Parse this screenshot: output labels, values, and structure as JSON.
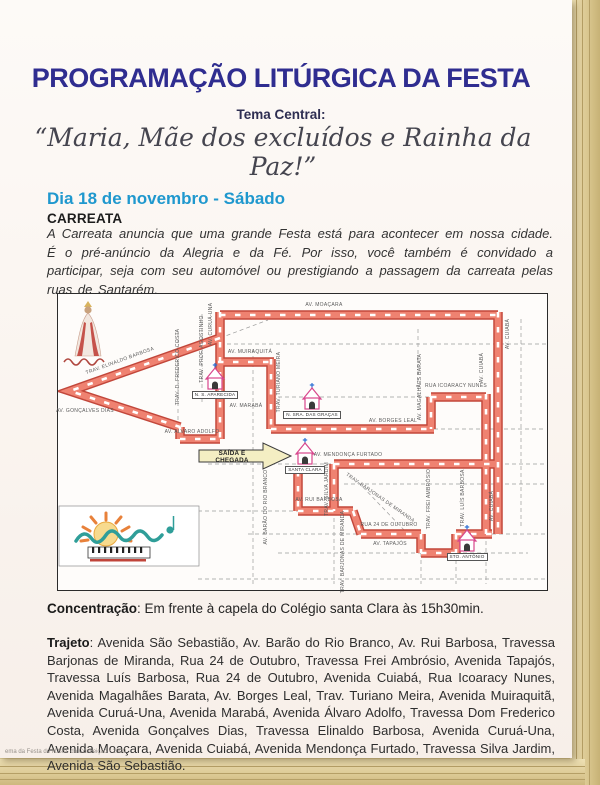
{
  "page": {
    "title": "PROGRAMAÇÃO LITÚRGICA DA FESTA",
    "subtitle_label": "Tema Central:",
    "theme_quote": "“Maria, Mãe dos excluídos e Rainha da Paz!”",
    "footer": "ema da Festa de N.Sra. da Conceição • 2000"
  },
  "section": {
    "day_heading": "Dia 18 de novembro - Sábado",
    "event_heading": "CARREATA",
    "event_description": "A Carreata anuncia que uma grande Festa está para acontecer em nossa cidade. É o pré-anúncio da Alegria e da Fé. Por isso, você também é convidado a participar, seja com seu automóvel ou prestigiando a passagem da carreata pelas ruas de Santarém."
  },
  "concentration": {
    "label": "Concentração",
    "text": ": Em frente à capela do Colégio santa Clara às 15h30min."
  },
  "route": {
    "label": "Trajeto",
    "text": ":  Avenida São Sebastião, Av. Barão do Rio Branco, Av. Rui Barbosa, Travessa Barjonas de Miranda, Rua 24 de Outubro, Travessa Frei Ambrósio, Avenida Tapajós, Travessa Luís Barbosa, Rua 24 de Outubro, Avenida Cuiabá, Rua Icoaracy Nunes, Avenida Magalhães Barata, Av. Borges Leal, Trav. Turiano Meira, Avenida Muiraquitã, Avenida Curuá-Una, Avenida Marabá, Avenida Álvaro Adolfo, Travessa Dom Frederico Costa, Avenida Gonçalves Dias, Travessa Elinaldo Barbosa, Avenida Curuá-Una, Avenida Moaçara, Avenida Cuiabá, Avenida Mendonça Furtado, Travessa Silva Jardim, Avenida São Sebastião."
  },
  "map": {
    "arrow_label": "SAÍDA E CHEGADA",
    "colors": {
      "route_border": "#c2473b",
      "route_fill": "#ef8271",
      "route_tick": "#ffffff",
      "church_pink": "#d8478d",
      "cross_blue": "#2a6fd4",
      "arrow_yellow": "#f4eec3"
    },
    "route_segments": [
      "M162,21 H440",
      "M440,18 V240",
      "M428,100 V240",
      "M373,103 H428",
      "M373,103 V135",
      "M213,135 H376",
      "M213,65 V135",
      "M160,68 H216",
      "M162,18 V145",
      "M122,145 H162",
      "M122,133 V145",
      "M162,44 L12,97 L122,133",
      "M276,170 H440",
      "M276,170 V217",
      "M240,177 V217",
      "M240,217 H295",
      "M295,217 L303,240",
      "M303,240 H363",
      "M363,240 V259",
      "M363,259 H398",
      "M398,240 V259",
      "M398,240 H434"
    ],
    "streets": [
      {
        "label": "AV. MOAÇARA",
        "x": 266,
        "y": 11,
        "rot": 0
      },
      {
        "label": "AV. CUIABÁ",
        "x": 450,
        "y": 40,
        "rot": -90
      },
      {
        "label": "AV. CUIABÁ",
        "x": 424,
        "y": 74,
        "rot": -90
      },
      {
        "label": "AV. CUIABÁ",
        "x": 434,
        "y": 212,
        "rot": -90
      },
      {
        "label": "RUA ICOARACY NUNES",
        "x": 398,
        "y": 92,
        "rot": 0
      },
      {
        "label": "AV. MAGALHÃES BARATA",
        "x": 362,
        "y": 93,
        "rot": -90
      },
      {
        "label": "AV. BORGES LEAL",
        "x": 335,
        "y": 127,
        "rot": 0
      },
      {
        "label": "TRAV. TURIANO MEIRA",
        "x": 221,
        "y": 88,
        "rot": -90
      },
      {
        "label": "AV. MUIRAQUITÁ",
        "x": 192,
        "y": 58,
        "rot": 0
      },
      {
        "label": "AV. CURUÁ-UNA",
        "x": 153,
        "y": 30,
        "rot": -90
      },
      {
        "label": "TRAV. PROF. AGOSTINHO",
        "x": 144,
        "y": 55,
        "rot": -90
      },
      {
        "label": "TRAV. D. FREDERICO COSTA",
        "x": 120,
        "y": 73,
        "rot": -90
      },
      {
        "label": "TRAV. ELINALDO BARBOSA",
        "x": 62,
        "y": 67,
        "rot": -20
      },
      {
        "label": "AV. GONÇALVES DIAS",
        "x": 27,
        "y": 117,
        "rot": 0
      },
      {
        "label": "AV. MARABÁ",
        "x": 188,
        "y": 112,
        "rot": 0
      },
      {
        "label": "AV. ALVARO ADOLFO",
        "x": 134,
        "y": 138,
        "rot": 0
      },
      {
        "label": "AV. MENDONÇA FURTADO",
        "x": 290,
        "y": 161,
        "rot": 0
      },
      {
        "label": "TRAV. SILVA JARDIM",
        "x": 269,
        "y": 195,
        "rot": -90
      },
      {
        "label": "AV. BARÃO DO RIO BRANCO",
        "x": 208,
        "y": 213,
        "rot": -90
      },
      {
        "label": "AV. RUI BARBOSA",
        "x": 261,
        "y": 206,
        "rot": 0
      },
      {
        "label": "TRAV. BARJONAS DE MIRANDA",
        "x": 322,
        "y": 204,
        "rot": 35
      },
      {
        "label": "TRAV. BARJONAS DE MIRANDA",
        "x": 285,
        "y": 258,
        "rot": -90
      },
      {
        "label": "RUA 24 DE OUTUBRO",
        "x": 331,
        "y": 231,
        "rot": 0
      },
      {
        "label": "AV. TAPAJÓS",
        "x": 332,
        "y": 250,
        "rot": 0
      },
      {
        "label": "TRAV. FREI AMBRÓSIO",
        "x": 371,
        "y": 205,
        "rot": -90
      },
      {
        "label": "TRAV. LUÍS BARBOSA",
        "x": 405,
        "y": 204,
        "rot": -90
      }
    ],
    "churches": [
      {
        "name": "N. S. APARECIDA",
        "x": 157,
        "y": 68
      },
      {
        "name": "N. SRA. DAS GRAÇAS",
        "x": 254,
        "y": 88
      },
      {
        "name": "SANTA CLARA",
        "x": 247,
        "y": 143
      },
      {
        "name": "STO. ANTÔNIO",
        "x": 409,
        "y": 230
      }
    ]
  }
}
